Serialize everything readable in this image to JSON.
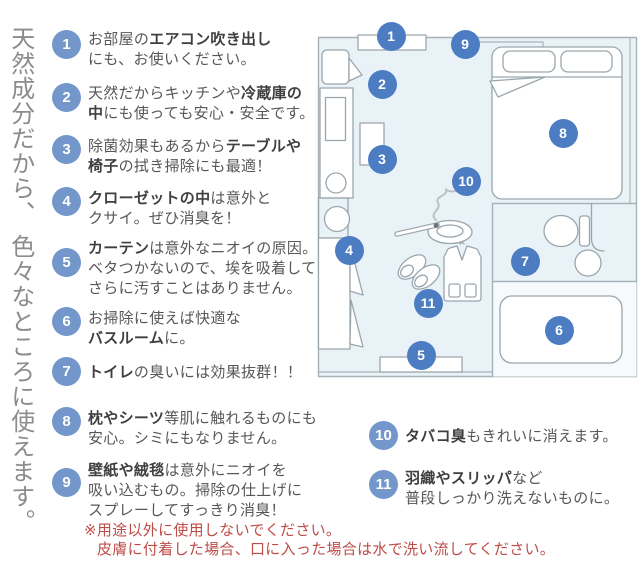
{
  "title": {
    "vertical_text": "天然成分だから、 色々なところに使えます。"
  },
  "items": [
    {
      "n": "1",
      "lines": [
        [
          {
            "t": "お部屋の"
          },
          {
            "t": "エアコン吹き出し",
            "b": true
          }
        ],
        [
          {
            "t": "にも、お使いください。"
          }
        ]
      ]
    },
    {
      "n": "2",
      "lines": [
        [
          {
            "t": "天然だからキッチンや"
          },
          {
            "t": "冷蔵庫の",
            "b": true
          }
        ],
        [
          {
            "t": "中",
            "b": true
          },
          {
            "t": "にも使っても安心・安全です。"
          }
        ]
      ]
    },
    {
      "n": "3",
      "lines": [
        [
          {
            "t": "除菌効果もあるから"
          },
          {
            "t": "テーブルや",
            "b": true
          }
        ],
        [
          {
            "t": "椅子",
            "b": true
          },
          {
            "t": "の拭き掃除にも最適！"
          }
        ]
      ]
    },
    {
      "n": "4",
      "lines": [
        [
          {
            "t": "クローゼットの中",
            "b": true
          },
          {
            "t": "は意外と"
          }
        ],
        [
          {
            "t": "クサイ。ぜひ消臭を！"
          }
        ]
      ]
    },
    {
      "n": "5",
      "lines": [
        [
          {
            "t": "カーテン",
            "b": true
          },
          {
            "t": "は意外なニオイの原因。"
          }
        ],
        [
          {
            "t": "ベタつかないので、埃を吸着して"
          }
        ],
        [
          {
            "t": "さらに汚すことはありません。"
          }
        ]
      ]
    },
    {
      "n": "6",
      "lines": [
        [
          {
            "t": "お掃除に使えば快適な"
          }
        ],
        [
          {
            "t": "バスルーム",
            "b": true
          },
          {
            "t": "に。"
          }
        ]
      ]
    },
    {
      "n": "7",
      "lines": [
        [
          {
            "t": "トイレ",
            "b": true
          },
          {
            "t": "の臭いには効果抜群！！"
          }
        ]
      ]
    },
    {
      "n": "8",
      "lines": [
        [
          {
            "t": "枕やシーツ",
            "b": true
          },
          {
            "t": "等肌に触れるものにも"
          }
        ],
        [
          {
            "t": "安心。シミにもなりません。"
          }
        ]
      ]
    },
    {
      "n": "9",
      "lines": [
        [
          {
            "t": "壁紙や絨毯",
            "b": true
          },
          {
            "t": "は意外にニオイを"
          }
        ],
        [
          {
            "t": "吸い込むもの。掃除の仕上げに"
          }
        ],
        [
          {
            "t": "スプレーしてすっきり消臭！"
          }
        ]
      ]
    },
    {
      "n": "10",
      "lines": [
        [
          {
            "t": "タバコ臭",
            "b": true
          },
          {
            "t": "もきれいに消えます。"
          }
        ]
      ]
    },
    {
      "n": "11",
      "lines": [
        [
          {
            "t": "羽織やスリッパ",
            "b": true
          },
          {
            "t": "など"
          }
        ],
        [
          {
            "t": "普段しっかり洗えないものに。"
          }
        ]
      ]
    }
  ],
  "plan": {
    "markers": [
      {
        "n": "1",
        "x": 391,
        "y": 36
      },
      {
        "n": "2",
        "x": 382,
        "y": 84
      },
      {
        "n": "3",
        "x": 382,
        "y": 159
      },
      {
        "n": "4",
        "x": 349,
        "y": 250
      },
      {
        "n": "5",
        "x": 421,
        "y": 355
      },
      {
        "n": "6",
        "x": 559,
        "y": 330
      },
      {
        "n": "7",
        "x": 525,
        "y": 261
      },
      {
        "n": "8",
        "x": 563,
        "y": 133
      },
      {
        "n": "9",
        "x": 465,
        "y": 44
      },
      {
        "n": "10",
        "x": 466,
        "y": 181
      },
      {
        "n": "11",
        "x": 428,
        "y": 303
      }
    ]
  },
  "note": {
    "lines": [
      "※用途以外に使用しないでください。",
      "皮膚に付着した場合、口に入った場合は水で洗い流してください。"
    ]
  },
  "colors": {
    "list_circle_blue": "#7397ca",
    "plan_circle_blue": "#4c7dc3",
    "warning_red": "#bf4b47",
    "plan_background": "#e9f2f7"
  }
}
